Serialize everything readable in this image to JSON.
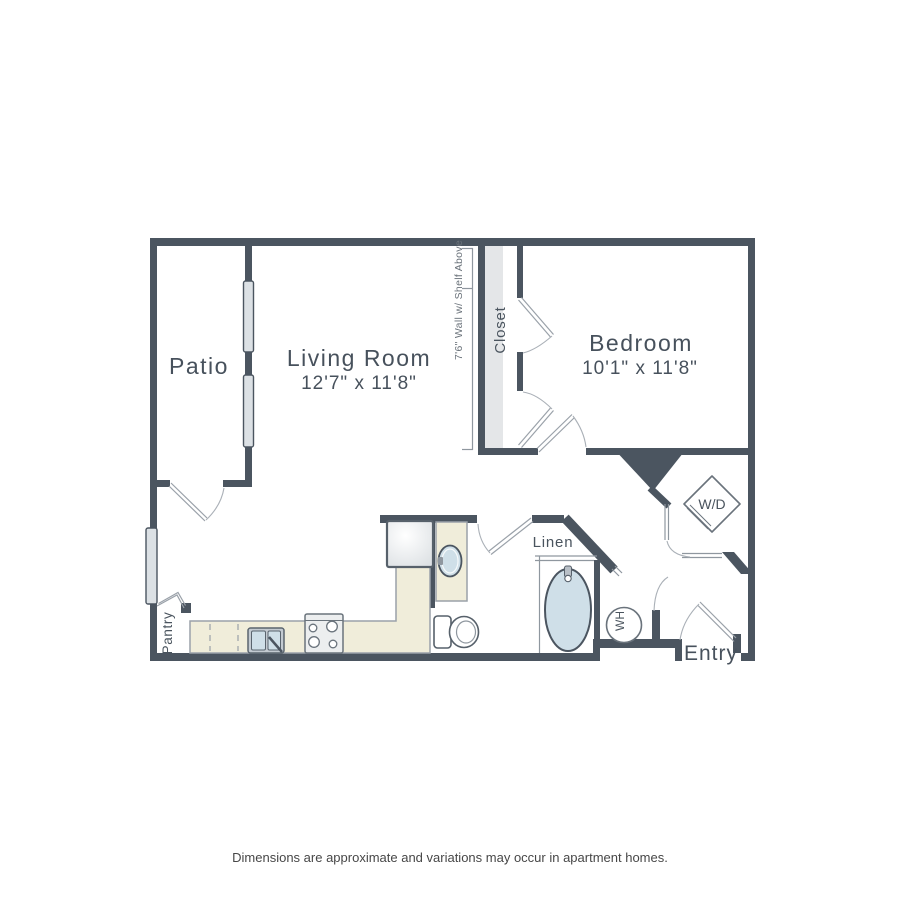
{
  "plan": {
    "patio": {
      "label": "Patio"
    },
    "living_room": {
      "label": "Living Room",
      "dims": "12'7\" x 11'8\""
    },
    "bedroom": {
      "label": "Bedroom",
      "dims": "10'1\" x 11'8\""
    },
    "closet": {
      "label": "Closet"
    },
    "wall_note": "7'6\" Wall w/ Shelf Above",
    "pantry": {
      "label": "Pantry"
    },
    "linen": {
      "label": "Linen"
    },
    "washer_dryer": {
      "label": "W/D"
    },
    "water_heater": {
      "label": "WH"
    },
    "entry": {
      "label": "Entry"
    }
  },
  "footer": {
    "disclaimer": "Dimensions are approximate and variations may occur in apartment homes."
  },
  "colors": {
    "wall": "#4b5560",
    "counter": "#f0edda",
    "fixture_blue": "#cfdfe8",
    "closet_shelf": "#e4e6e8",
    "window_glass": "#dce1e5",
    "label_text": "#47515c"
  }
}
